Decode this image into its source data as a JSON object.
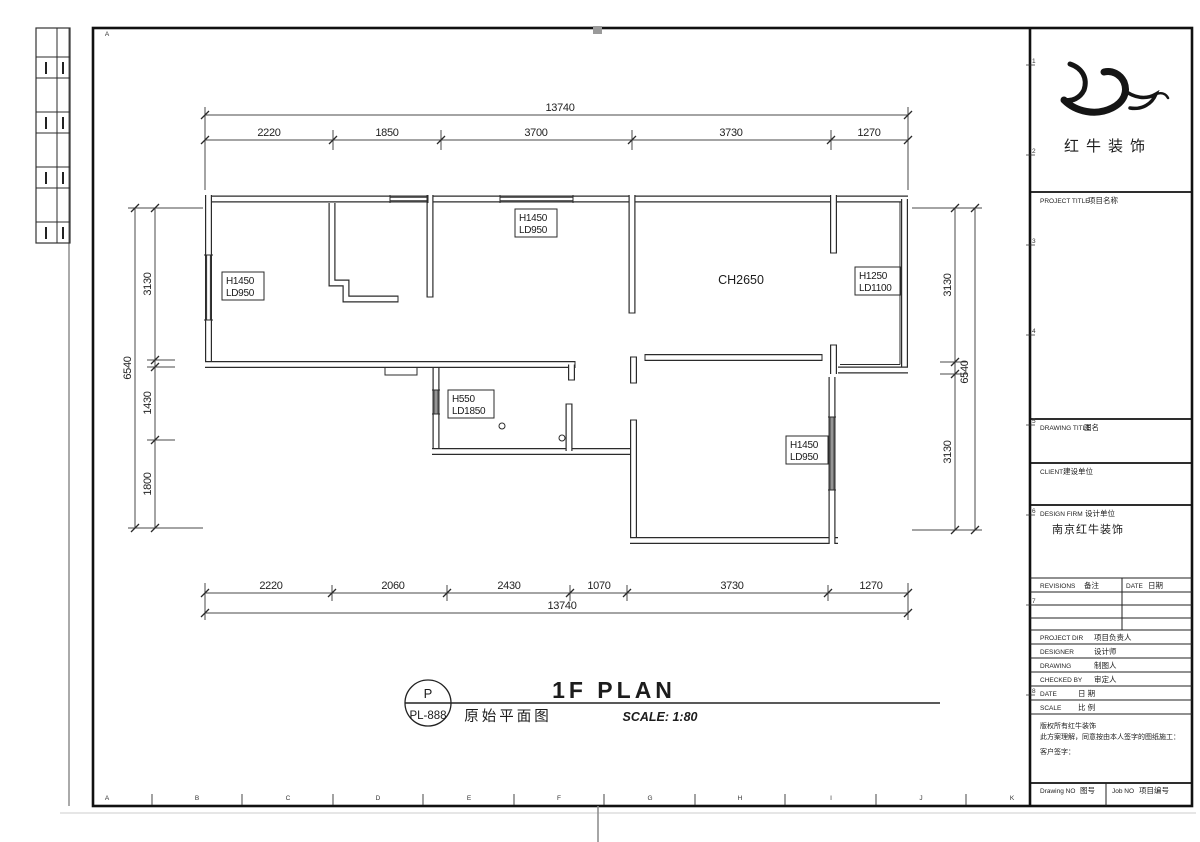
{
  "plan": {
    "ceiling_note": "CH2650",
    "tags": [
      {
        "l1": "H1450",
        "l2": "LD950"
      },
      {
        "l1": "H1450",
        "l2": "LD950"
      },
      {
        "l1": "H1250",
        "l2": "LD1100"
      },
      {
        "l1": "H550",
        "l2": "LD1850"
      },
      {
        "l1": "H1450",
        "l2": "LD950"
      }
    ]
  },
  "dims": {
    "top": {
      "overall": "13740",
      "segments": [
        "2220",
        "1850",
        "3700",
        "3730",
        "1270"
      ]
    },
    "bottom": {
      "overall": "13740",
      "segments": [
        "2220",
        "2060",
        "2430",
        "1070",
        "3730",
        "1270"
      ]
    },
    "left": {
      "overall": "6540",
      "segments": [
        "3130",
        "1430",
        "1800"
      ]
    },
    "right": {
      "overall": "6540",
      "segments": [
        "3130",
        "3130"
      ]
    }
  },
  "caption": {
    "badge_top": "P",
    "badge_bottom": "PL-888",
    "title": "1F PLAN",
    "subtitle": "原始平面图",
    "scale": "SCALE: 1:80"
  },
  "titleblock": {
    "brand": "红牛装饰",
    "project_title": {
      "en": "PROJECT TITLE",
      "cn": "项目名称"
    },
    "drawing_title": {
      "en": "DRAWING TITLE",
      "cn": "图名"
    },
    "client": {
      "en": "CLIENT",
      "cn": "建设单位"
    },
    "design_firm": {
      "en": "DESIGN FIRM",
      "cn": "设计单位",
      "value": "南京红牛装饰"
    },
    "revisions": {
      "en": "REVISIONS",
      "cn": "备注"
    },
    "date_col": {
      "en": "DATE",
      "cn": "日期"
    },
    "rows": [
      {
        "en": "PROJECT DIR",
        "cn": "项目负责人"
      },
      {
        "en": "DESIGNER",
        "cn": "设计师"
      },
      {
        "en": "DRAWING",
        "cn": "制图人"
      },
      {
        "en": "CHECKED BY",
        "cn": "审定人"
      },
      {
        "en": "DATE",
        "cn": "日 期"
      },
      {
        "en": "SCALE",
        "cn": "比 例"
      }
    ],
    "note": [
      "版权所有红牛装饰",
      "此方案理解，同意按由本人签字的图纸施工：",
      "客户签字："
    ],
    "drawing_no": {
      "en": "Drawing NO",
      "cn": "图号"
    },
    "job_no": {
      "en": "Job NO",
      "cn": "项目编号"
    }
  },
  "grid": {
    "bottom": [
      "A",
      "B",
      "C",
      "D",
      "E",
      "F",
      "G",
      "H",
      "I",
      "J",
      "K"
    ],
    "right": [
      "1",
      "2",
      "3",
      "4",
      "5",
      "6",
      "7",
      "8"
    ],
    "top": [
      "A"
    ]
  }
}
